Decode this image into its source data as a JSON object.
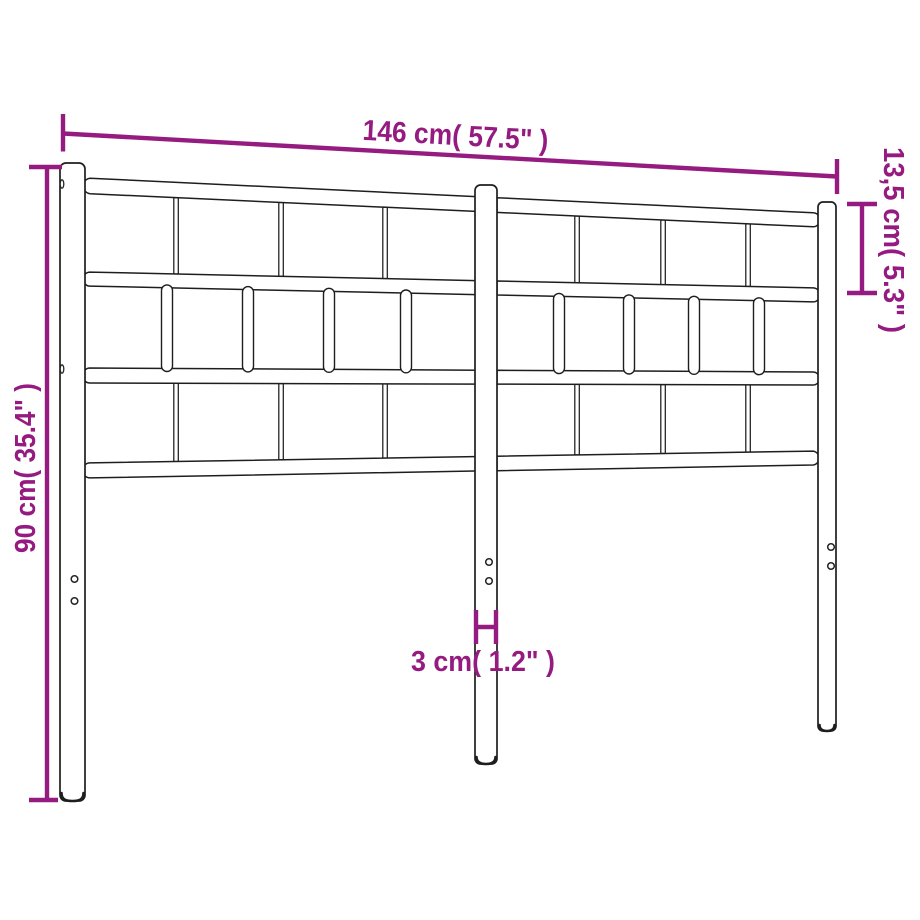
{
  "diagram": {
    "type": "product-dimension-diagram",
    "subject": "metal-headboard",
    "background_color": "#ffffff",
    "outline_color": "#1e1e1e",
    "dimension_color": "#951b81",
    "dimensions": {
      "width": {
        "label": "146 cm( 57.5\" )",
        "cm": 146,
        "inches": 57.5,
        "orientation": "horizontal-top"
      },
      "height": {
        "label": "90 cm( 35.4\" )",
        "cm": 90,
        "inches": 35.4,
        "orientation": "vertical-left"
      },
      "upper_section_height": {
        "label": "13,5 cm( 5.3\" )",
        "cm": 13.5,
        "inches": 5.3,
        "orientation": "vertical-right"
      },
      "post_width": {
        "label": "3 cm( 1.2\" )",
        "cm": 3,
        "inches": 1.2,
        "orientation": "horizontal-center-bottom"
      }
    },
    "structure": {
      "posts": 3,
      "horizontal_rails": 4,
      "top_row_slats": 6,
      "middle_row_wide_slats": 8,
      "bottom_row_slats": 6,
      "screw_hole_pairs": 3
    }
  }
}
